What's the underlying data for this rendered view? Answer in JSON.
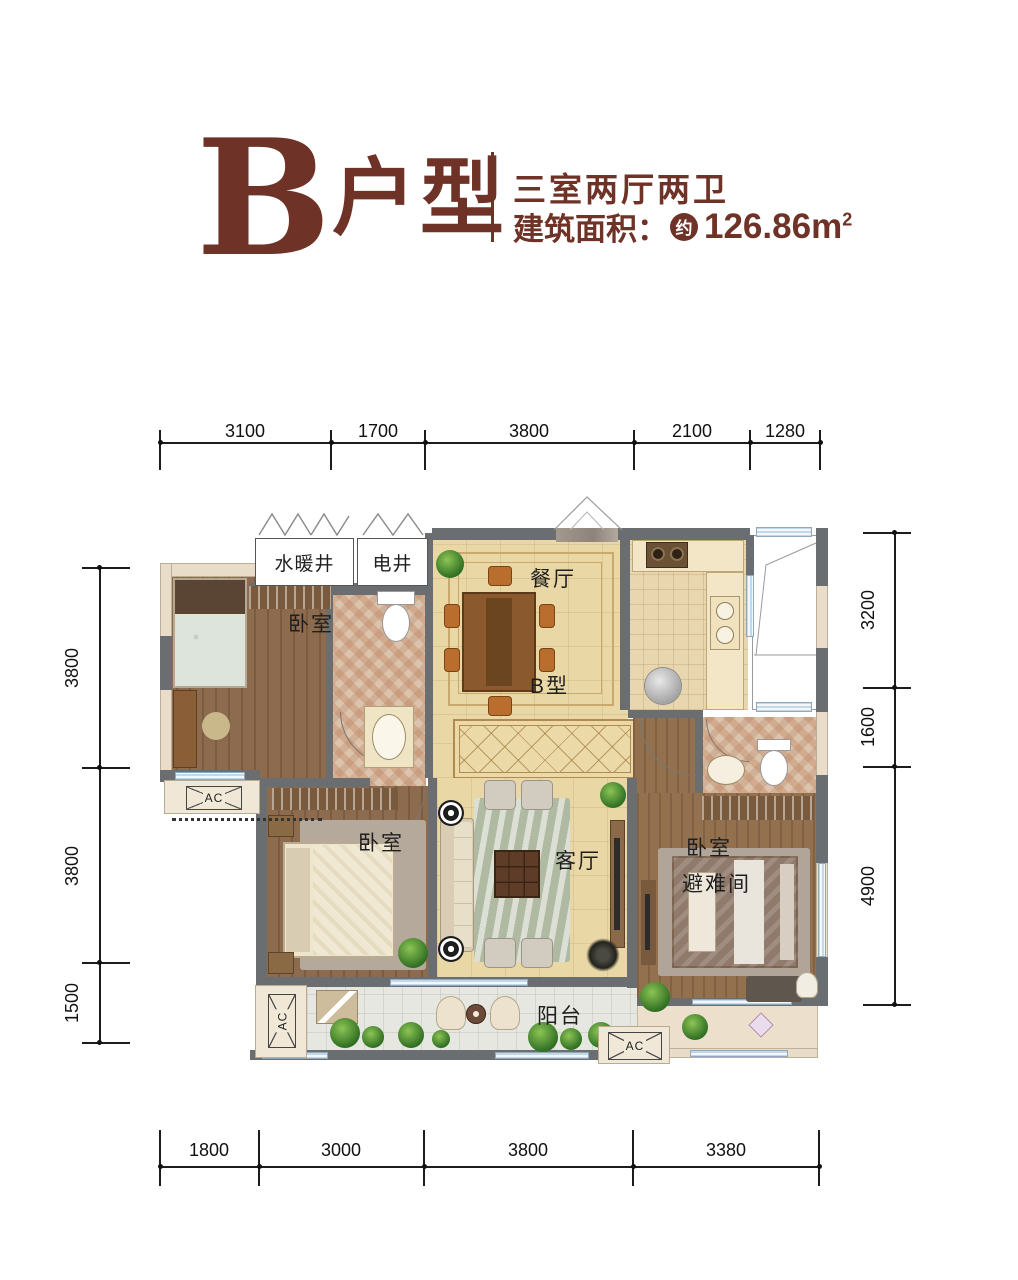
{
  "header": {
    "unit_letter": "B",
    "unit_suffix": "户型",
    "spec_line": "三室两厅两卫",
    "area_label": "建筑面积：",
    "approx_badge": "约",
    "area_value": "126.86",
    "area_unit_base": "m",
    "area_unit_exp": "2"
  },
  "dimensions": {
    "top": [
      "3100",
      "1700",
      "3800",
      "2100",
      "1280"
    ],
    "bottom": [
      "1800",
      "3000",
      "3800",
      "3380"
    ],
    "left": [
      "3800",
      "3800",
      "1500"
    ],
    "right": [
      "3200",
      "1600",
      "4900"
    ]
  },
  "rooms": {
    "water_shaft": "水暖井",
    "electric_shaft": "电井",
    "dining": "餐厅",
    "unit_mark": "B型",
    "bedroom_top": "卧室",
    "bedroom_mid": "卧室",
    "bedroom_right": "卧室",
    "refuge": "避难间",
    "living": "客厅",
    "balcony": "阳台",
    "ac": "AC"
  },
  "colors": {
    "accent": "#6E3227",
    "wall_dark": "#6B6E71",
    "wood_floor": "#8D6B4E",
    "floor_beige": "#E9D7A6",
    "window_blue": "#C3D7E7",
    "bath_tile": "#DCC3AB"
  }
}
